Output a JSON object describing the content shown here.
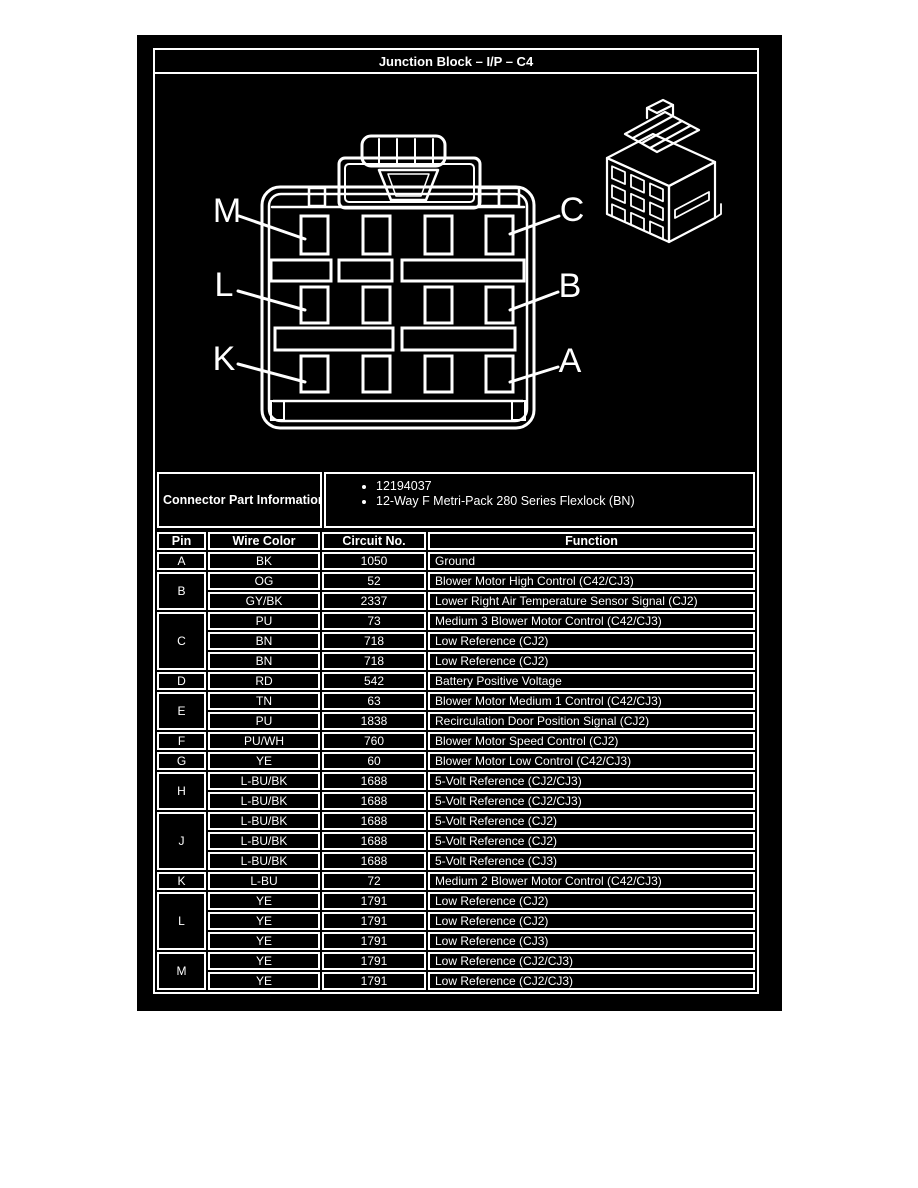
{
  "title": "Junction Block – I/P – C4",
  "colors": {
    "page_background": "#ffffff",
    "panel_background": "#000000",
    "line_and_text": "#ffffff"
  },
  "diagram": {
    "pin_labels_left": [
      "M",
      "L",
      "K"
    ],
    "pin_labels_right": [
      "C",
      "B",
      "A"
    ],
    "cavity_rows": 3,
    "cavity_columns": 4
  },
  "connector_part_information": {
    "label": "Connector Part Information",
    "items": [
      "12194037",
      "12-Way F Metri-Pack 280 Series Flexlock (BN)"
    ]
  },
  "pin_table": {
    "headers": [
      "Pin",
      "Wire Color",
      "Circuit No.",
      "Function"
    ],
    "groups": [
      {
        "pin": "A",
        "rows": [
          [
            "BK",
            "1050",
            "Ground"
          ]
        ]
      },
      {
        "pin": "B",
        "rows": [
          [
            "OG",
            "52",
            "Blower Motor High Control (C42/CJ3)"
          ],
          [
            "GY/BK",
            "2337",
            "Lower Right Air Temperature Sensor Signal (CJ2)"
          ]
        ]
      },
      {
        "pin": "C",
        "rows": [
          [
            "PU",
            "73",
            "Medium 3 Blower Motor Control (C42/CJ3)"
          ],
          [
            "BN",
            "718",
            "Low Reference (CJ2)"
          ],
          [
            "BN",
            "718",
            "Low Reference (CJ2)"
          ]
        ]
      },
      {
        "pin": "D",
        "rows": [
          [
            "RD",
            "542",
            "Battery Positive Voltage"
          ]
        ]
      },
      {
        "pin": "E",
        "rows": [
          [
            "TN",
            "63",
            "Blower Motor Medium 1 Control (C42/CJ3)"
          ],
          [
            "PU",
            "1838",
            "Recirculation Door Position Signal (CJ2)"
          ]
        ]
      },
      {
        "pin": "F",
        "rows": [
          [
            "PU/WH",
            "760",
            "Blower Motor Speed Control (CJ2)"
          ]
        ]
      },
      {
        "pin": "G",
        "rows": [
          [
            "YE",
            "60",
            "Blower Motor Low Control (C42/CJ3)"
          ]
        ]
      },
      {
        "pin": "H",
        "rows": [
          [
            "L-BU/BK",
            "1688",
            "5-Volt Reference (CJ2/CJ3)"
          ],
          [
            "L-BU/BK",
            "1688",
            "5-Volt Reference (CJ2/CJ3)"
          ]
        ]
      },
      {
        "pin": "J",
        "rows": [
          [
            "L-BU/BK",
            "1688",
            "5-Volt Reference (CJ2)"
          ],
          [
            "L-BU/BK",
            "1688",
            "5-Volt Reference (CJ2)"
          ],
          [
            "L-BU/BK",
            "1688",
            "5-Volt Reference (CJ3)"
          ]
        ]
      },
      {
        "pin": "K",
        "rows": [
          [
            "L-BU",
            "72",
            "Medium 2 Blower Motor Control (C42/CJ3)"
          ]
        ]
      },
      {
        "pin": "L",
        "rows": [
          [
            "YE",
            "1791",
            "Low Reference (CJ2)"
          ],
          [
            "YE",
            "1791",
            "Low Reference (CJ2)"
          ],
          [
            "YE",
            "1791",
            "Low Reference (CJ3)"
          ]
        ]
      },
      {
        "pin": "M",
        "rows": [
          [
            "YE",
            "1791",
            "Low Reference (CJ2/CJ3)"
          ],
          [
            "YE",
            "1791",
            "Low Reference (CJ2/CJ3)"
          ]
        ]
      }
    ]
  }
}
